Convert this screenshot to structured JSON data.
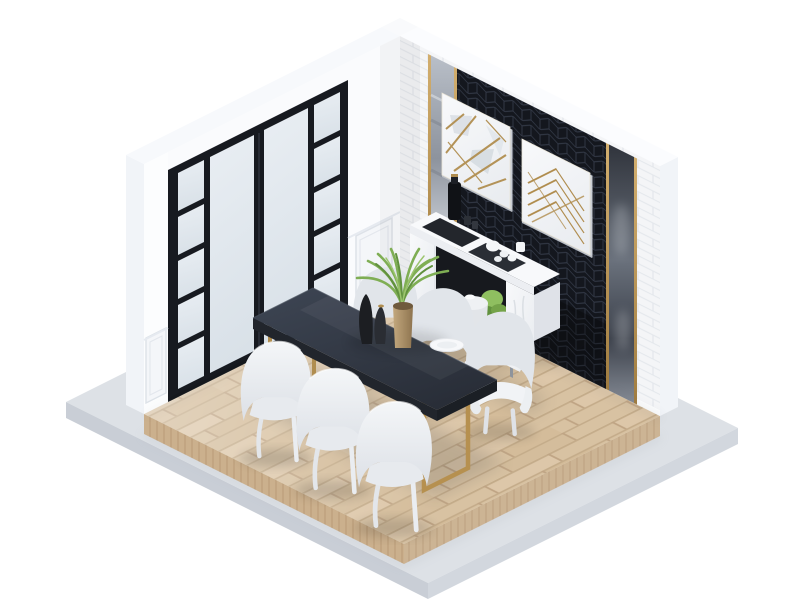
{
  "meta": {
    "type": "isometric-3d-interior-render",
    "room": "dining-room",
    "style": "modern black-white-gold cutaway room on floating platform"
  },
  "palette": {
    "bg": "#ffffff",
    "wall": "#fafbfd",
    "wall-edge": "#f1f4f8",
    "top-band": "#f7f9fc",
    "brick": "#f4f5f7",
    "mortar": "#e4e7ec",
    "frame-black": "#171a20",
    "glass-a": "#e9eef3",
    "glass-b": "#d9e1e8",
    "panel": "#14171e",
    "panel-line": "#3a4150",
    "gold": "#b08d4f",
    "gold-light": "#d2ae6e",
    "mirror-a": "#c7ccd3",
    "mirror-b": "#5f6570",
    "wood-a": "#d8c2a2",
    "wood-line": "#c2a987",
    "wood-end": "#cbb08d",
    "platform": "#dde1e6",
    "platform-side": "#c9ced6",
    "table-a": "#3c4350",
    "table-b": "#2b303a",
    "table-side": "#21252c",
    "table-end": "#1b1f25",
    "chair-a": "#f4f6f8",
    "chair-b": "#dde1e7",
    "marble": "#f6f7f9",
    "marble-shade": "#e2e5ea",
    "interior-dark": "#17191e",
    "plant-a": "#7fae54",
    "plant-b": "#61913e",
    "tan-a": "#c3a87e",
    "tan-b": "#8e744f"
  },
  "scene": {
    "description": "Isometric render of a dining room: white walls, black framed windows, black hexagon-tile accent wall with gold-line artwork, long charcoal dining table with brass legs, six off-white chairs, white marble sideboard with coffee trays, oak plank deck on a concrete platform.",
    "room": {
      "left_wall": {
        "type": "white wall with black-framed floor-to-ceiling frosted windows",
        "large_panes": 2,
        "side_ladder_columns": 2,
        "panes_per_ladder_column": 5,
        "wainscot_panels": 2
      },
      "right_wall": {
        "type": "white brick wall with black hexagon-tile accent panel",
        "art_frames": 2,
        "mirror_strips": 2,
        "gold_trims": 4
      },
      "floor": {
        "deck": "light oak planks",
        "base": "concrete platform slab"
      }
    },
    "furniture": {
      "dining_table": {
        "top": "charcoal",
        "legs": "brass sled frames",
        "length_seats": 6
      },
      "chairs": {
        "count": 6,
        "color": "off-white",
        "front_row": 3,
        "back_row": 3
      },
      "sideboard": {
        "material": "white marble, angled hexagonal profile",
        "top_items": [
          "black bottle tray",
          "tea set tray"
        ],
        "shelf_items": [
          "potted green plant"
        ]
      },
      "side_stool": {
        "count": 1,
        "color": "white"
      }
    },
    "decor": {
      "centerpiece": [
        "green fern in tan vase",
        "black sculptural bottles",
        "white plate"
      ],
      "artwork": "two white square panels with gold geometric line art"
    }
  }
}
